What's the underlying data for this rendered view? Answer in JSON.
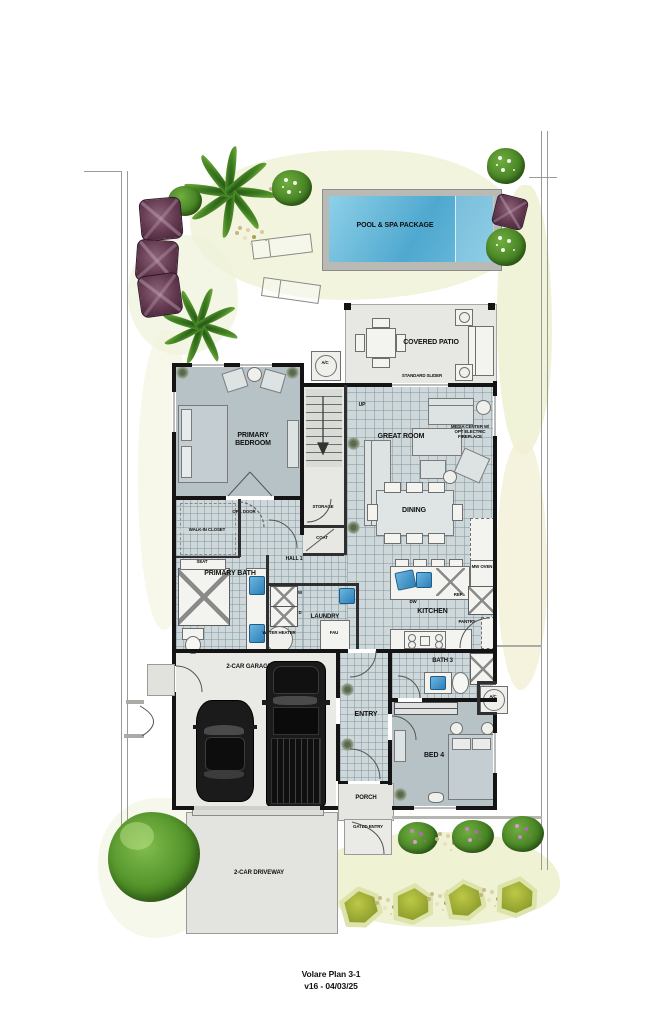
{
  "footer": {
    "title": "Volare Plan 3-1",
    "version": "v16 - 04/03/25"
  },
  "site": {
    "pool": "POOL & SPA PACKAGE",
    "covered_patio": "COVERED PATIO",
    "standard_slider": "STANDARD SLIDER",
    "ac_unit": "A/C",
    "porch": "PORCH",
    "gated_entry": "GATED ENTRY",
    "driveway": "2-CAR DRIVEWAY"
  },
  "rooms": {
    "primary_bedroom": "PRIMARY BEDROOM",
    "great_room": "GREAT ROOM",
    "media_center": "MEDIA CENTER W/ OPT ELECTRIC FIREPLACE",
    "dining": "DINING",
    "kitchen": "KITCHEN",
    "storage": "STORAGE",
    "coat": "COAT",
    "hall1": "HALL 1",
    "walk_in_closet": "WALK-IN CLOSET",
    "primary_bath": "PRIMARY BATH",
    "laundry": "LAUNDRY",
    "bath3": "BATH 3",
    "entry": "ENTRY",
    "bed4": "BED 4",
    "garage": "2-CAR GARAGE"
  },
  "fixtures": {
    "up": "UP",
    "opt_door": "OPT. DOOR",
    "seat": "SEAT",
    "water_heater": "WATER HEATER",
    "fau": "FAU",
    "washer": "W",
    "dryer": "D",
    "dw": "DW",
    "mw_oven": "MW OVEN",
    "ref": "REF",
    "pantry": "PANTRY"
  },
  "colors": {
    "pool_water": "#5fb6d9",
    "room_fill": "#b6c2c6",
    "tile_floor": "#ced7d9",
    "wall": "#141414",
    "landscape_wash": "#eef0d4",
    "tree_green": "#4e8f26",
    "shrub_purple": "#5d3a50",
    "hedge_olive": "#9eae33",
    "sink_blue": "#2e86c1"
  }
}
